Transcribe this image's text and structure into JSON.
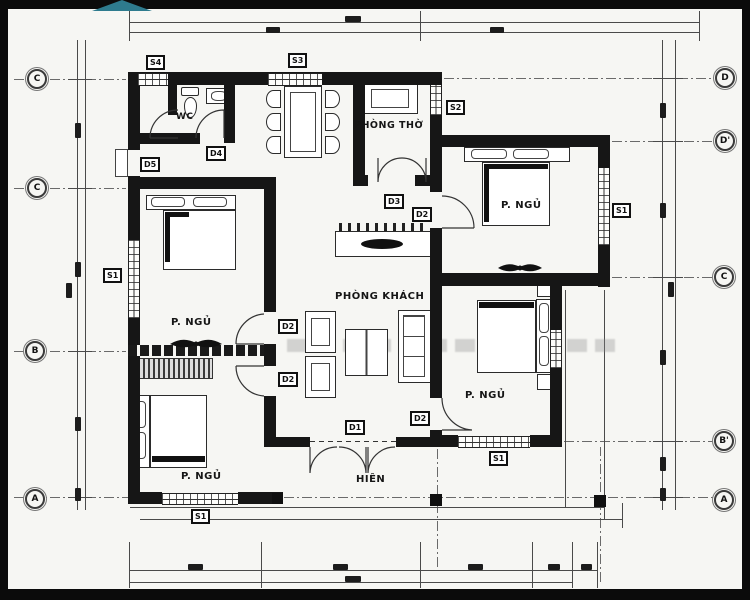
{
  "room_labels": {
    "wc": "WC",
    "worship_room": "PHÒNG THỜ",
    "living_room": "PHÒNG KHÁCH",
    "bedroom": "P. NGỦ",
    "porch": "HIÊN"
  },
  "opening_tags": {
    "s1": "S1",
    "s2": "S2",
    "s3": "S3",
    "s4": "S4",
    "d1": "D1",
    "d2": "D2",
    "d3": "D3",
    "d4": "D4",
    "d5": "D5"
  },
  "grid_markers": {
    "a": "A",
    "b": "B",
    "b_prime": "B'",
    "c": "C",
    "d": "D",
    "d_prime": "D'"
  },
  "colors": {
    "wall": "#161616",
    "line": "#4a4a4a",
    "accent_triangle": "#2e7b8e",
    "paper": "#f6f6f3"
  }
}
